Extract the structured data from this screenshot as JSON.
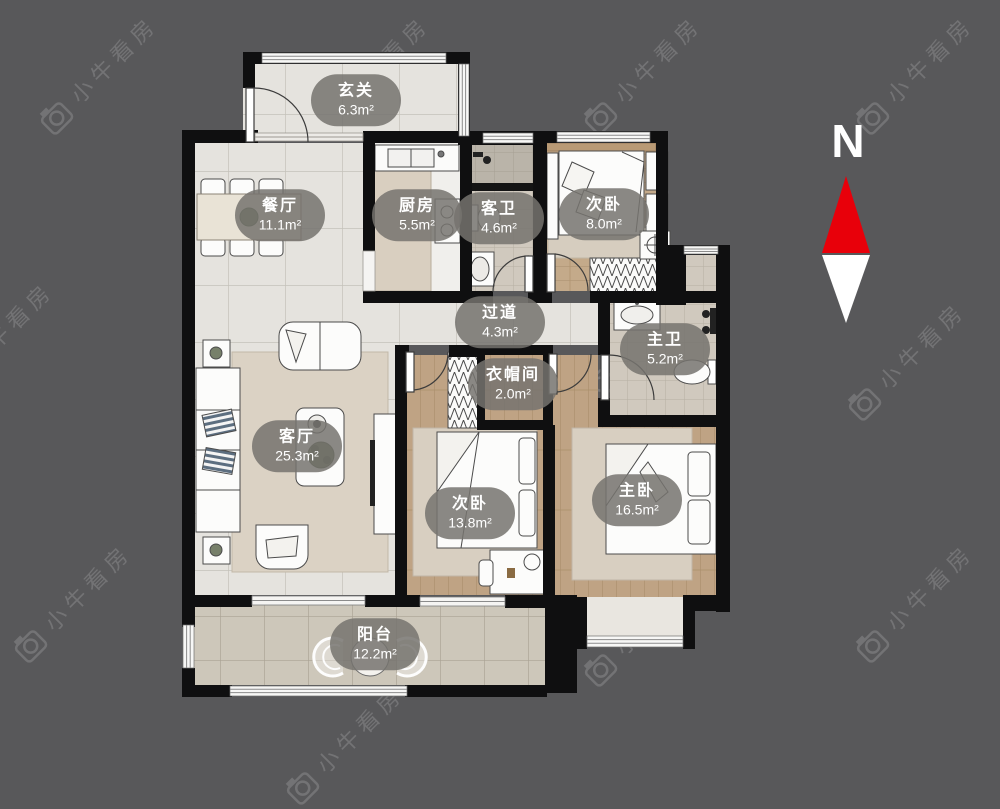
{
  "watermark": {
    "text": "小牛看房"
  },
  "compass": {
    "label": "N",
    "north_color": "#e8000a",
    "south_color": "#ffffff"
  },
  "rooms": [
    {
      "id": "entry",
      "name": "玄关",
      "area": "6.3m²"
    },
    {
      "id": "dining",
      "name": "餐厅",
      "area": "11.1m²"
    },
    {
      "id": "kitchen",
      "name": "厨房",
      "area": "5.5m²"
    },
    {
      "id": "guest-bath",
      "name": "客卫",
      "area": "4.6m²"
    },
    {
      "id": "bedroom-small",
      "name": "次卧",
      "area": "8.0m²"
    },
    {
      "id": "corridor",
      "name": "过道",
      "area": "4.3m²"
    },
    {
      "id": "master-bath",
      "name": "主卫",
      "area": "5.2m²"
    },
    {
      "id": "walk-in-closet",
      "name": "衣帽间",
      "area": "2.0m²"
    },
    {
      "id": "living",
      "name": "客厅",
      "area": "25.3m²"
    },
    {
      "id": "bedroom-second",
      "name": "次卧",
      "area": "13.8m²"
    },
    {
      "id": "master-bedroom",
      "name": "主卧",
      "area": "16.5m²"
    },
    {
      "id": "balcony",
      "name": "阳台",
      "area": "12.2m²"
    }
  ]
}
